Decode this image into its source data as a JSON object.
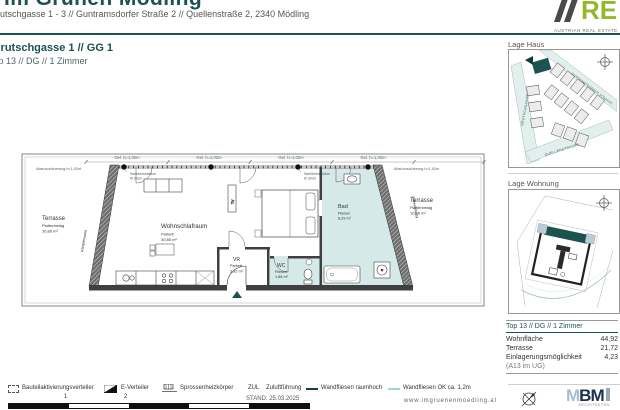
{
  "header": {
    "title_clipped": "Im Grünen Mödling",
    "address": "Grutschgasse 1 - 3 // Guntramsdorfer Straße 2 // Quellenstraße 2, 2340 Mödling",
    "logo_text": "RE",
    "logo_sub": "AUSTRIAN REAL ESTATE"
  },
  "unit": {
    "line1": "Grutschgasse 1 // GG 1",
    "line2": "Top 13 // DG // 1 Zimmer"
  },
  "plan": {
    "annotations": {
      "absturz": "Absturzsicherung h=1,02m",
      "gel": "Gel. h=1,02m",
      "column1": "Stahlbetonstütze",
      "column2": "Ø 20cm",
      "diag_wall": "Kämpferwand",
      "tv": "TV"
    },
    "rooms": {
      "terrasse_left": {
        "name": "Terrasse",
        "finish": "Plattenbelag",
        "area": "10,86 m²"
      },
      "wohnschlafraum": {
        "name": "Wohnschlafraum",
        "finish": "Parkett",
        "area": "30,85 m²"
      },
      "vr": {
        "name": "VR",
        "finish": "Parkett",
        "area": "3,92 m²"
      },
      "wc": {
        "name": "WC",
        "finish": "Fliesen",
        "area": "1,86 m²"
      },
      "bad": {
        "name": "Bad",
        "finish": "Fliesen",
        "area": "8,29 m²"
      },
      "terrasse_right": {
        "name": "Terrasse",
        "finish": "Plattenbelag",
        "area": "10,86 m²"
      }
    }
  },
  "sidebar": {
    "lage_haus_title": "Lage Haus",
    "streets": {
      "left": "GRUTSCHGASSE",
      "diag": "GUNTRAMSDORFER STRASSE",
      "bottom": "QUELLENSTRASSE"
    },
    "lage_wohnung_title": "Lage Wohnung",
    "summary": {
      "title": "Top 13 // DG // 1 Zimmer",
      "rows": [
        {
          "label": "Wohnfläche",
          "value": "44,92"
        },
        {
          "label": "Terrasse",
          "value": "21,72"
        },
        {
          "label": "Einlagerungsmöglichkeit",
          "value": "4,23"
        },
        {
          "label": "(A13 im UG)",
          "value": ""
        }
      ]
    },
    "mbm": {
      "m": "M",
      "bm": "BM",
      "sub": "ARCHITEKTEN"
    }
  },
  "legend": {
    "items": [
      {
        "label": "Bauteilaktivierungsverteiler"
      },
      {
        "label": "E-Verteiler"
      },
      {
        "label": "Sprossenheizkörper"
      },
      {
        "abbr": "ZUL",
        "label": "Zuluftführung"
      },
      {
        "label": "Wandfliesen raumhoch"
      },
      {
        "label": "Wandfliesen OK ca. 1,2m"
      }
    ],
    "scale_ticks": [
      "1",
      "2"
    ],
    "stand": "STAND: 25.03.2025",
    "website": "www.imgruenenmoedling.at"
  },
  "colors": {
    "brand": "#1b534f",
    "logo_green": "#94b82c",
    "wet_room": "#d5eae8",
    "wall": "#3f3f3f"
  }
}
